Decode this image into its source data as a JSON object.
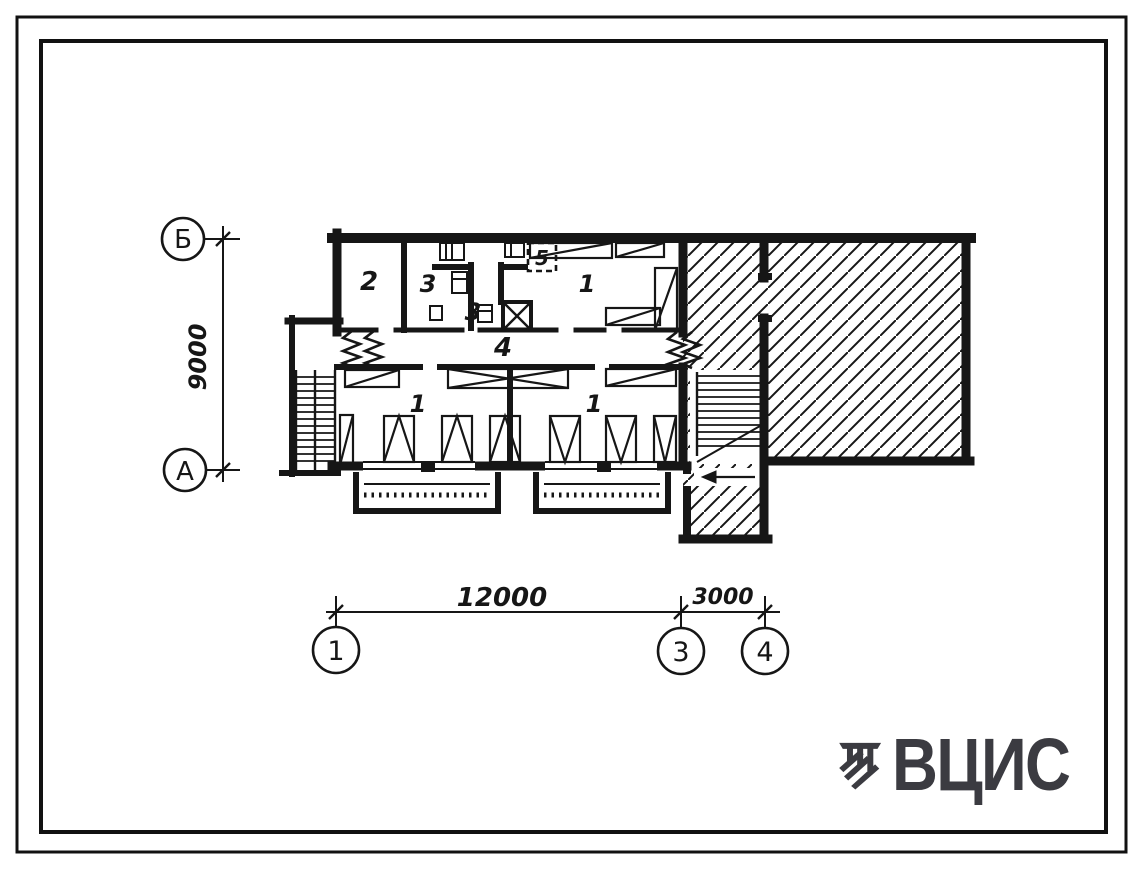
{
  "axis_markers": {
    "b": "Б",
    "a": "А",
    "n1": "1",
    "n3": "3",
    "n4": "4"
  },
  "dimensions": {
    "vertical": "9000",
    "horizontal_main": "12000",
    "horizontal_side": "3000"
  },
  "room_labels": {
    "r2": "2",
    "r3a": "3",
    "r3b": "3",
    "r5": "5",
    "r1top": "1",
    "r4": "4",
    "r1left": "1",
    "r1right": "1"
  },
  "logo": {
    "text": "ВЦИС",
    "color": "#3b3b41"
  },
  "colors": {
    "ink": "#161616",
    "paper": "#ffffff"
  }
}
